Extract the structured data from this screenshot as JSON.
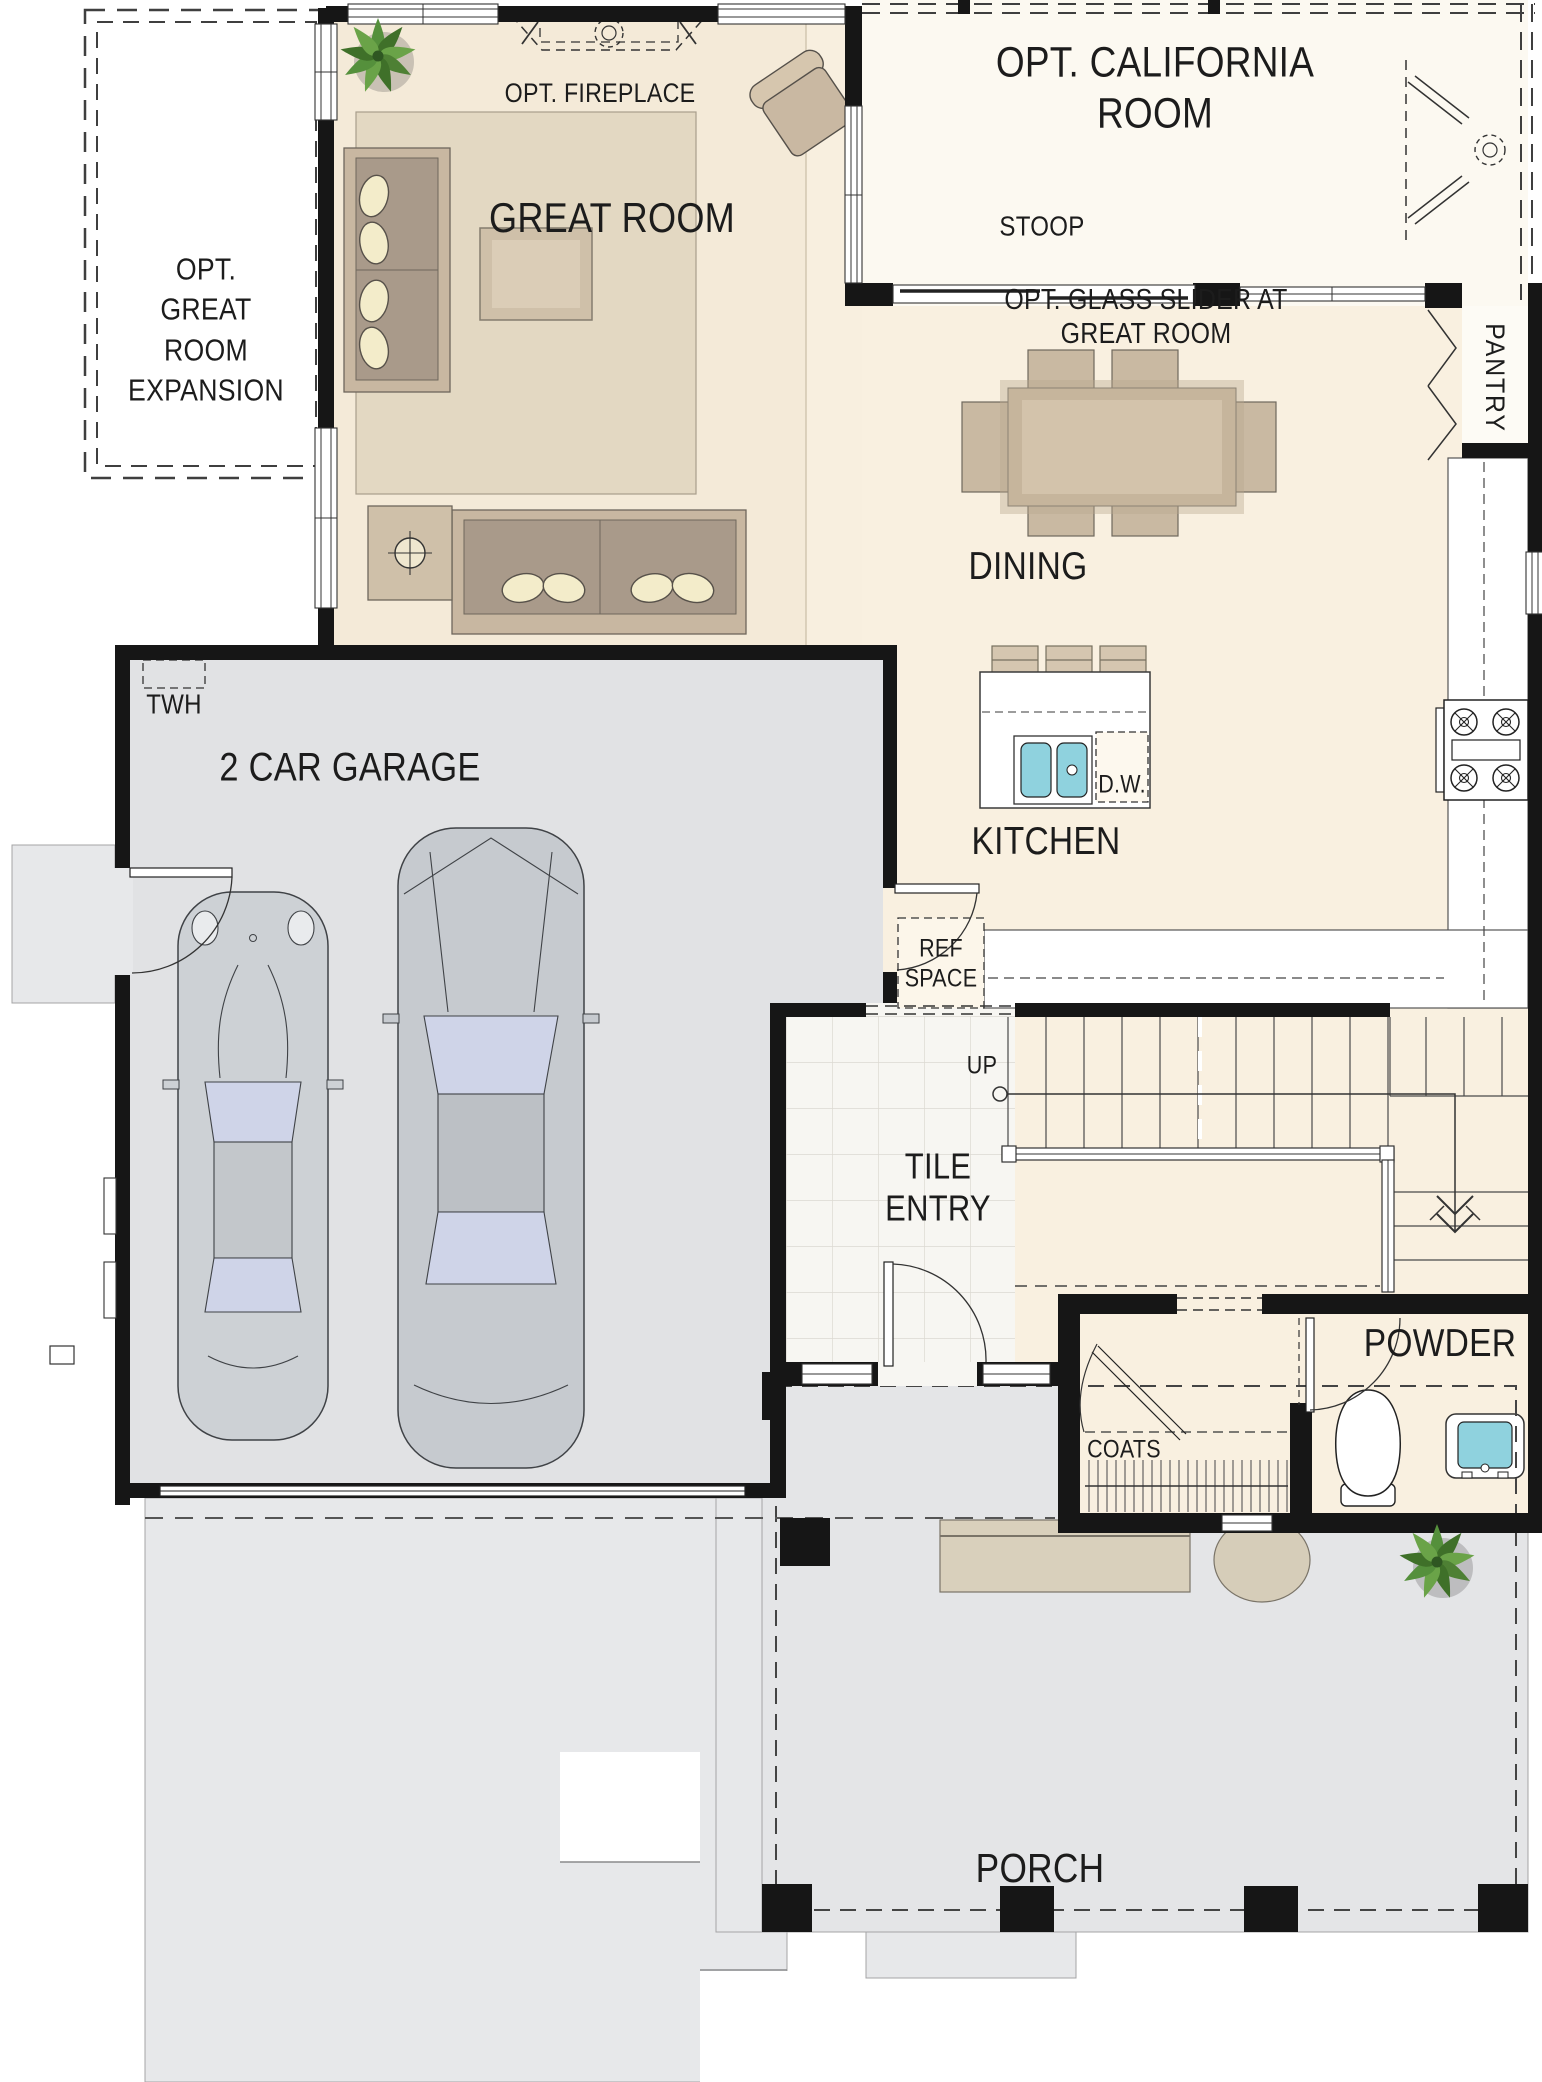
{
  "plan_title": "First floor residential floor plan",
  "labels": {
    "expansion": "OPT.\nGREAT\nROOM\nEXPANSION",
    "great_room": "GREAT ROOM",
    "opt_fireplace": "OPT. FIREPLACE",
    "california_room": "OPT. CALIFORNIA ROOM",
    "stoop": "STOOP",
    "glass_slider": "OPT. GLASS SLIDER AT GREAT ROOM",
    "pantry": "PANTRY",
    "dining": "DINING",
    "kitchen": "KITCHEN",
    "dishwasher": "D.W.",
    "ref_space": "REF\nSPACE",
    "twh": "TWH",
    "garage": "2 CAR GARAGE",
    "up": "UP",
    "tile_entry": "TILE\nENTRY",
    "powder": "POWDER",
    "coats": "COATS",
    "porch": "PORCH"
  },
  "colors": {
    "wall": "#161616",
    "floor_main": "#f9f0e0",
    "floor_great_room": "#f4ead8",
    "optional_room_white": "#fcf9f1",
    "rug": "#e3d8c2",
    "hardscape": "#e4e5e7",
    "driveway": "#e7e8ea",
    "stoop": "#dcdee1",
    "tile": "#f7f6f2",
    "furniture_tan": "#cbbba4",
    "sofa_cushion": "#a99a8a",
    "pillow": "#f3ecca",
    "sink_water": "#8fd2de",
    "plant_green": "#4e8034",
    "car_body": "#c9ccd1",
    "car_glass": "#cfd4e8"
  }
}
